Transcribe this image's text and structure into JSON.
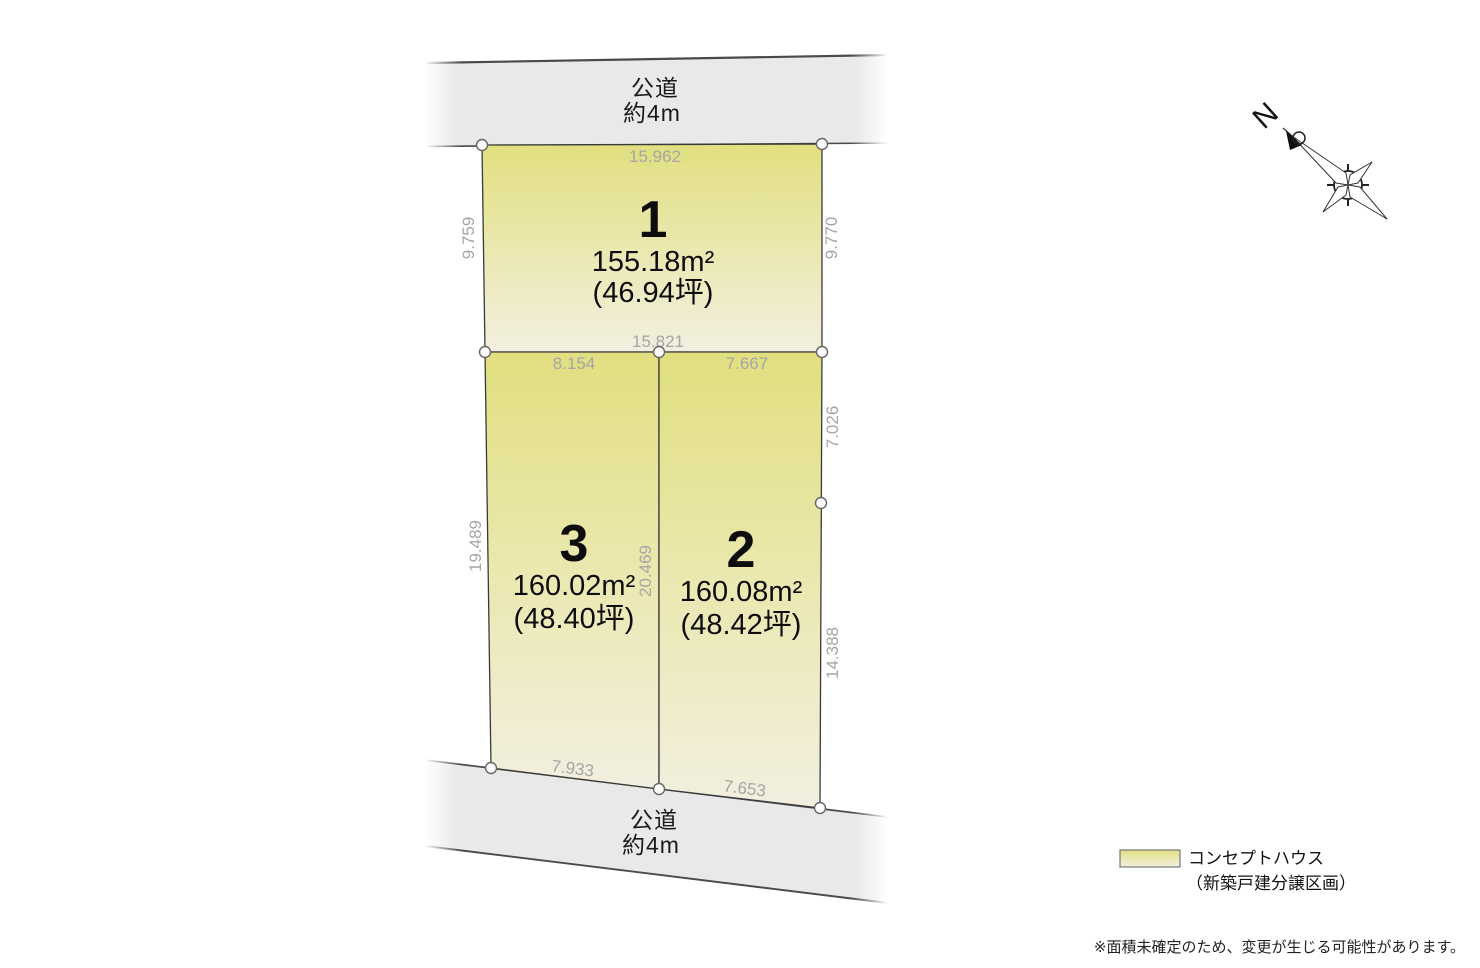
{
  "roads": {
    "top": {
      "name": "公道",
      "width": "約4m"
    },
    "bottom": {
      "name": "公道",
      "width": "約4m"
    }
  },
  "lots": [
    {
      "number": "1",
      "area": "155.18m²",
      "tsubo": "(46.94坪)",
      "dims": {
        "top": "15.962",
        "left": "9.759",
        "right": "9.770",
        "bottom": "15.821"
      }
    },
    {
      "number": "2",
      "area": "160.08m²",
      "tsubo": "(48.42坪)",
      "dims": {
        "top": "7.667",
        "right_upper": "7.026",
        "right_lower": "14.388",
        "bottom": "7.653"
      }
    },
    {
      "number": "3",
      "area": "160.02m²",
      "tsubo": "(48.40坪)",
      "dims": {
        "top": "8.154",
        "left": "19.489",
        "divider": "20.469",
        "bottom": "7.933"
      }
    }
  ],
  "compass": {
    "north_label": "N"
  },
  "legend": {
    "line1": "コンセプトハウス",
    "line2": "（新築戸建分譲区画）"
  },
  "note": "※面積未確定のため、変更が生じる可能性があります。",
  "colors": {
    "lot_fill_top": "#e1df7f",
    "lot_fill_mid": "#eae7ab",
    "lot_fill_bottom": "#f2efe0",
    "road_fill": "#e9e9e9",
    "outline": "#3a3a3a",
    "dimension_text": "#a5a5a5"
  }
}
